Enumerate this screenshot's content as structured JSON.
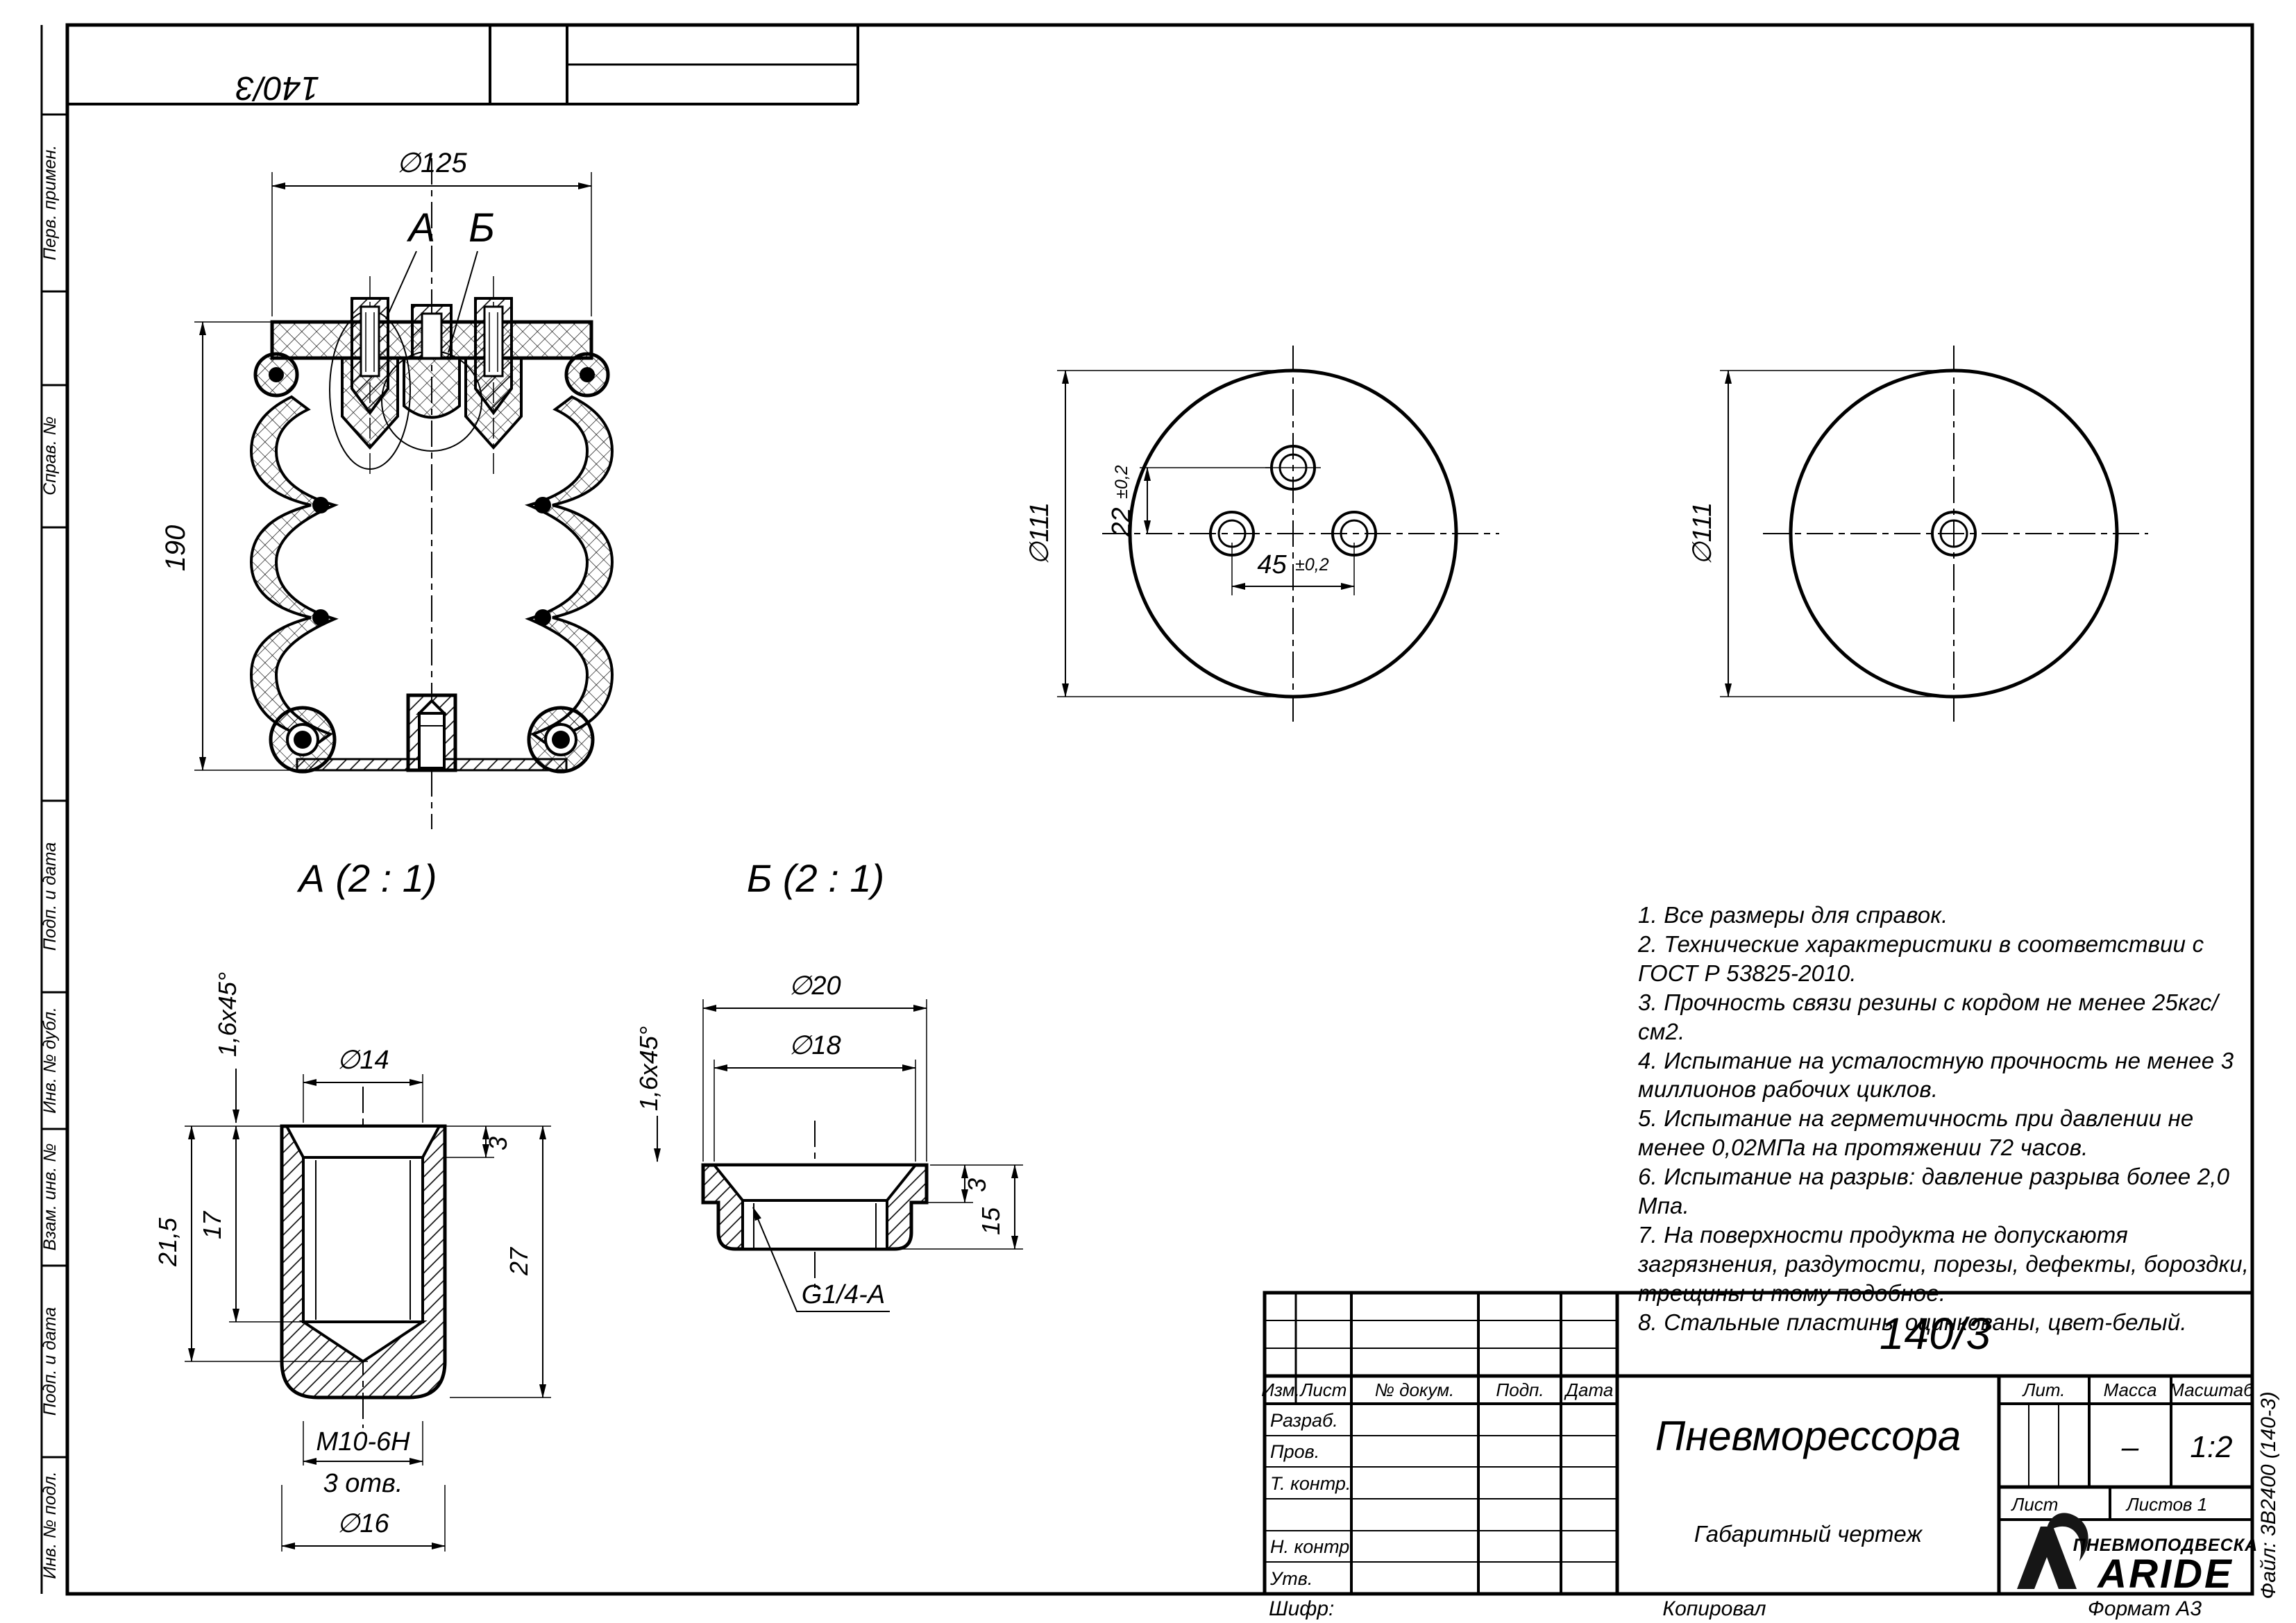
{
  "frame": {
    "top_stamp_number": "140/3",
    "margin_labels": [
      "Перв. примен.",
      "Справ. №",
      "Подп. и дата",
      "Инв. № дубл.",
      "Взам. инв. №",
      "Подп. и дата",
      "Инв. № подл."
    ],
    "file_label": "Файл: 3В2400 (140-3)",
    "footer": {
      "shifr": "Шифр:",
      "kopiroval": "Копировал",
      "format": "Формат А3"
    }
  },
  "front_view": {
    "dia125": "∅125",
    "h190": "190",
    "callout_a": "А",
    "callout_b": "Б"
  },
  "top_plate_view": {
    "dia111": "∅111",
    "dim22": "22",
    "tol22": "±0,2",
    "dim45": "45",
    "tol45": "±0,2"
  },
  "bottom_plate_view": {
    "dia111": "∅111"
  },
  "detail_a": {
    "title": "А (2 : 1)",
    "chamfer": "1,6x45°",
    "dia14": "∅14",
    "dim3": "3",
    "dim17": "17",
    "dim21_5": "21,5",
    "dim27": "27",
    "thread": "M10-6H",
    "holes": "3 отв.",
    "dia16": "∅16"
  },
  "detail_b": {
    "title": "Б (2 : 1)",
    "chamfer": "1,6x45°",
    "dia20": "∅20",
    "dia18": "∅18",
    "dim3": "3",
    "dim15": "15",
    "thread": "G1/4-A"
  },
  "notes": [
    "1. Все размеры для справок.",
    "2. Технические характеристики в соответствии с ГОСТ Р 53825-2010.",
    "3. Прочность связи резины с кордом не менее 25кгс/см2.",
    "4. Испытание на усталостную прочность не менее 3 миллионов рабочих циклов.",
    "5. Испытание на герметичность при давлении не менее 0,02МПа на протяжении 72 часов.",
    "6. Испытание на разрыв: давление разрыва более 2,0 Мпа.",
    "7. На поверхности продукта не допускаютя загрязнения, раздутости, порезы, дефекты, бороздки, трещины и тому подобное.",
    "8. Стальные пластины оцинкованы, цвет-белый."
  ],
  "title_block": {
    "doc_number": "140/3",
    "part_name": "Пневморессора",
    "doc_type": "Габаритный чертеж",
    "col_izm": "Изм.",
    "col_list": "Лист",
    "col_doc": "№ докум.",
    "col_podp": "Подп.",
    "col_data": "Дата",
    "row_razrab": "Разраб.",
    "row_prov": "Пров.",
    "row_tkontr": "Т. контр.",
    "row_nkontr": "Н. контр.",
    "row_utv": "Утв.",
    "lit_label": "Лит.",
    "massa_label": "Масса",
    "masshtab_label": "Масштаб",
    "massa_value": "–",
    "masshtab_value": "1:2",
    "list_label": "Лист",
    "listov_label": "Листов 1",
    "brand_top": "ПНЕВМОПОДВЕСКА",
    "brand_name": "ARIDE"
  }
}
